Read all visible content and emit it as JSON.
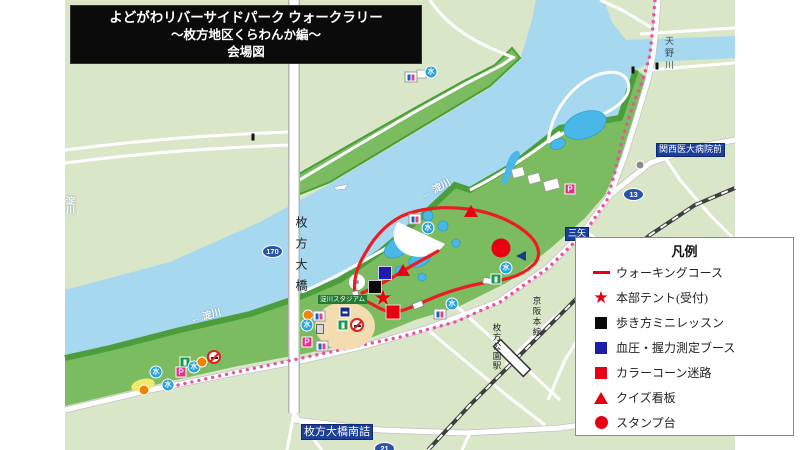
{
  "title": {
    "line1": "よどがわリバーサイドパーク ウォークラリー",
    "line2": "〜枚方地区くらわんか編〜",
    "line3": "会場図"
  },
  "legend": {
    "title": "凡例",
    "items": [
      {
        "symbol": "line",
        "color": "#e60012",
        "label": "ウォーキングコース"
      },
      {
        "symbol": "star",
        "color": "#e60012",
        "label": "本部テント(受付)"
      },
      {
        "symbol": "square",
        "color": "#0a0a0a",
        "label": "歩き方ミニレッスン"
      },
      {
        "symbol": "square",
        "color": "#1d1dac",
        "label": "血圧・握力測定ブース"
      },
      {
        "symbol": "square",
        "color": "#e60012",
        "label": "カラーコーン迷路"
      },
      {
        "symbol": "triangle",
        "color": "#e60012",
        "label": "クイズ看板"
      },
      {
        "symbol": "circle",
        "color": "#e60012",
        "label": "スタンプ台"
      }
    ]
  },
  "map": {
    "glyphs": {
      "water": "水",
      "parking": "P",
      "star": "★"
    },
    "labels": {
      "river_left": "← 淀川",
      "river_left_vertical": "淀川",
      "river_mid": "← 淀川",
      "amano_river": "天野川",
      "bridge": "枚方大橋",
      "keihan_line": "京阪本線",
      "hirakatakoen_station": "枚方公園駅",
      "stadium": "淀川スタジアム",
      "hospital_stop": "関西医大病院前",
      "mitsuya_stop": "三矢",
      "minamizume_stop": "枚方大橋南詰",
      "route_bridge": "170",
      "route_13": "13",
      "route_21": "21"
    },
    "colors": {
      "land": "#d9e6c8",
      "park": "#7abc5f",
      "shore": "#4c9e3c",
      "river": "#a6d8f0",
      "pond": "#49b8e8",
      "course": "#ec1c24",
      "bus_route": "#e8549f",
      "badge_blue": "#1c3f99"
    },
    "markers": [
      {
        "type": "quiz",
        "x": 471,
        "y": 211
      },
      {
        "type": "quiz",
        "x": 403,
        "y": 270
      },
      {
        "type": "stamp",
        "x": 501,
        "y": 248
      },
      {
        "type": "bp",
        "x": 385,
        "y": 273
      },
      {
        "type": "lesson",
        "x": 375,
        "y": 287
      },
      {
        "type": "hq",
        "x": 383,
        "y": 298
      },
      {
        "type": "maze",
        "x": 393,
        "y": 312
      }
    ],
    "icons": [
      {
        "type": "restroom",
        "x": 411,
        "y": 77
      },
      {
        "type": "water",
        "x": 431,
        "y": 72
      },
      {
        "type": "restroom",
        "x": 415,
        "y": 219
      },
      {
        "type": "water",
        "x": 428,
        "y": 228
      },
      {
        "type": "water",
        "x": 506,
        "y": 268
      },
      {
        "type": "green",
        "x": 496,
        "y": 279
      },
      {
        "type": "yacht",
        "x": 521,
        "y": 256
      },
      {
        "type": "water",
        "x": 452,
        "y": 304
      },
      {
        "type": "restroom",
        "x": 440,
        "y": 314
      },
      {
        "type": "orange",
        "x": 308,
        "y": 315
      },
      {
        "type": "restroom",
        "x": 319,
        "y": 316
      },
      {
        "type": "water",
        "x": 307,
        "y": 325
      },
      {
        "type": "monument",
        "x": 320,
        "y": 329
      },
      {
        "type": "parking",
        "x": 307,
        "y": 342
      },
      {
        "type": "restroom",
        "x": 322,
        "y": 346
      },
      {
        "type": "navy",
        "x": 345,
        "y": 312
      },
      {
        "type": "green",
        "x": 343,
        "y": 325
      },
      {
        "type": "nosmoke",
        "x": 357,
        "y": 325
      },
      {
        "type": "parking",
        "x": 570,
        "y": 189
      },
      {
        "type": "landmark",
        "x": 640,
        "y": 165
      },
      {
        "type": "water",
        "x": 156,
        "y": 372
      },
      {
        "type": "parking",
        "x": 181,
        "y": 372
      },
      {
        "type": "water",
        "x": 168,
        "y": 385
      },
      {
        "type": "orange",
        "x": 144,
        "y": 390
      },
      {
        "type": "green",
        "x": 185,
        "y": 362
      },
      {
        "type": "water",
        "x": 194,
        "y": 367
      },
      {
        "type": "orange",
        "x": 202,
        "y": 362
      },
      {
        "type": "nosmoke",
        "x": 214,
        "y": 357
      },
      {
        "type": "busstop",
        "x": 253,
        "y": 137
      },
      {
        "type": "busstop",
        "x": 633,
        "y": 70
      },
      {
        "type": "busstop",
        "x": 657,
        "y": 66
      }
    ]
  }
}
